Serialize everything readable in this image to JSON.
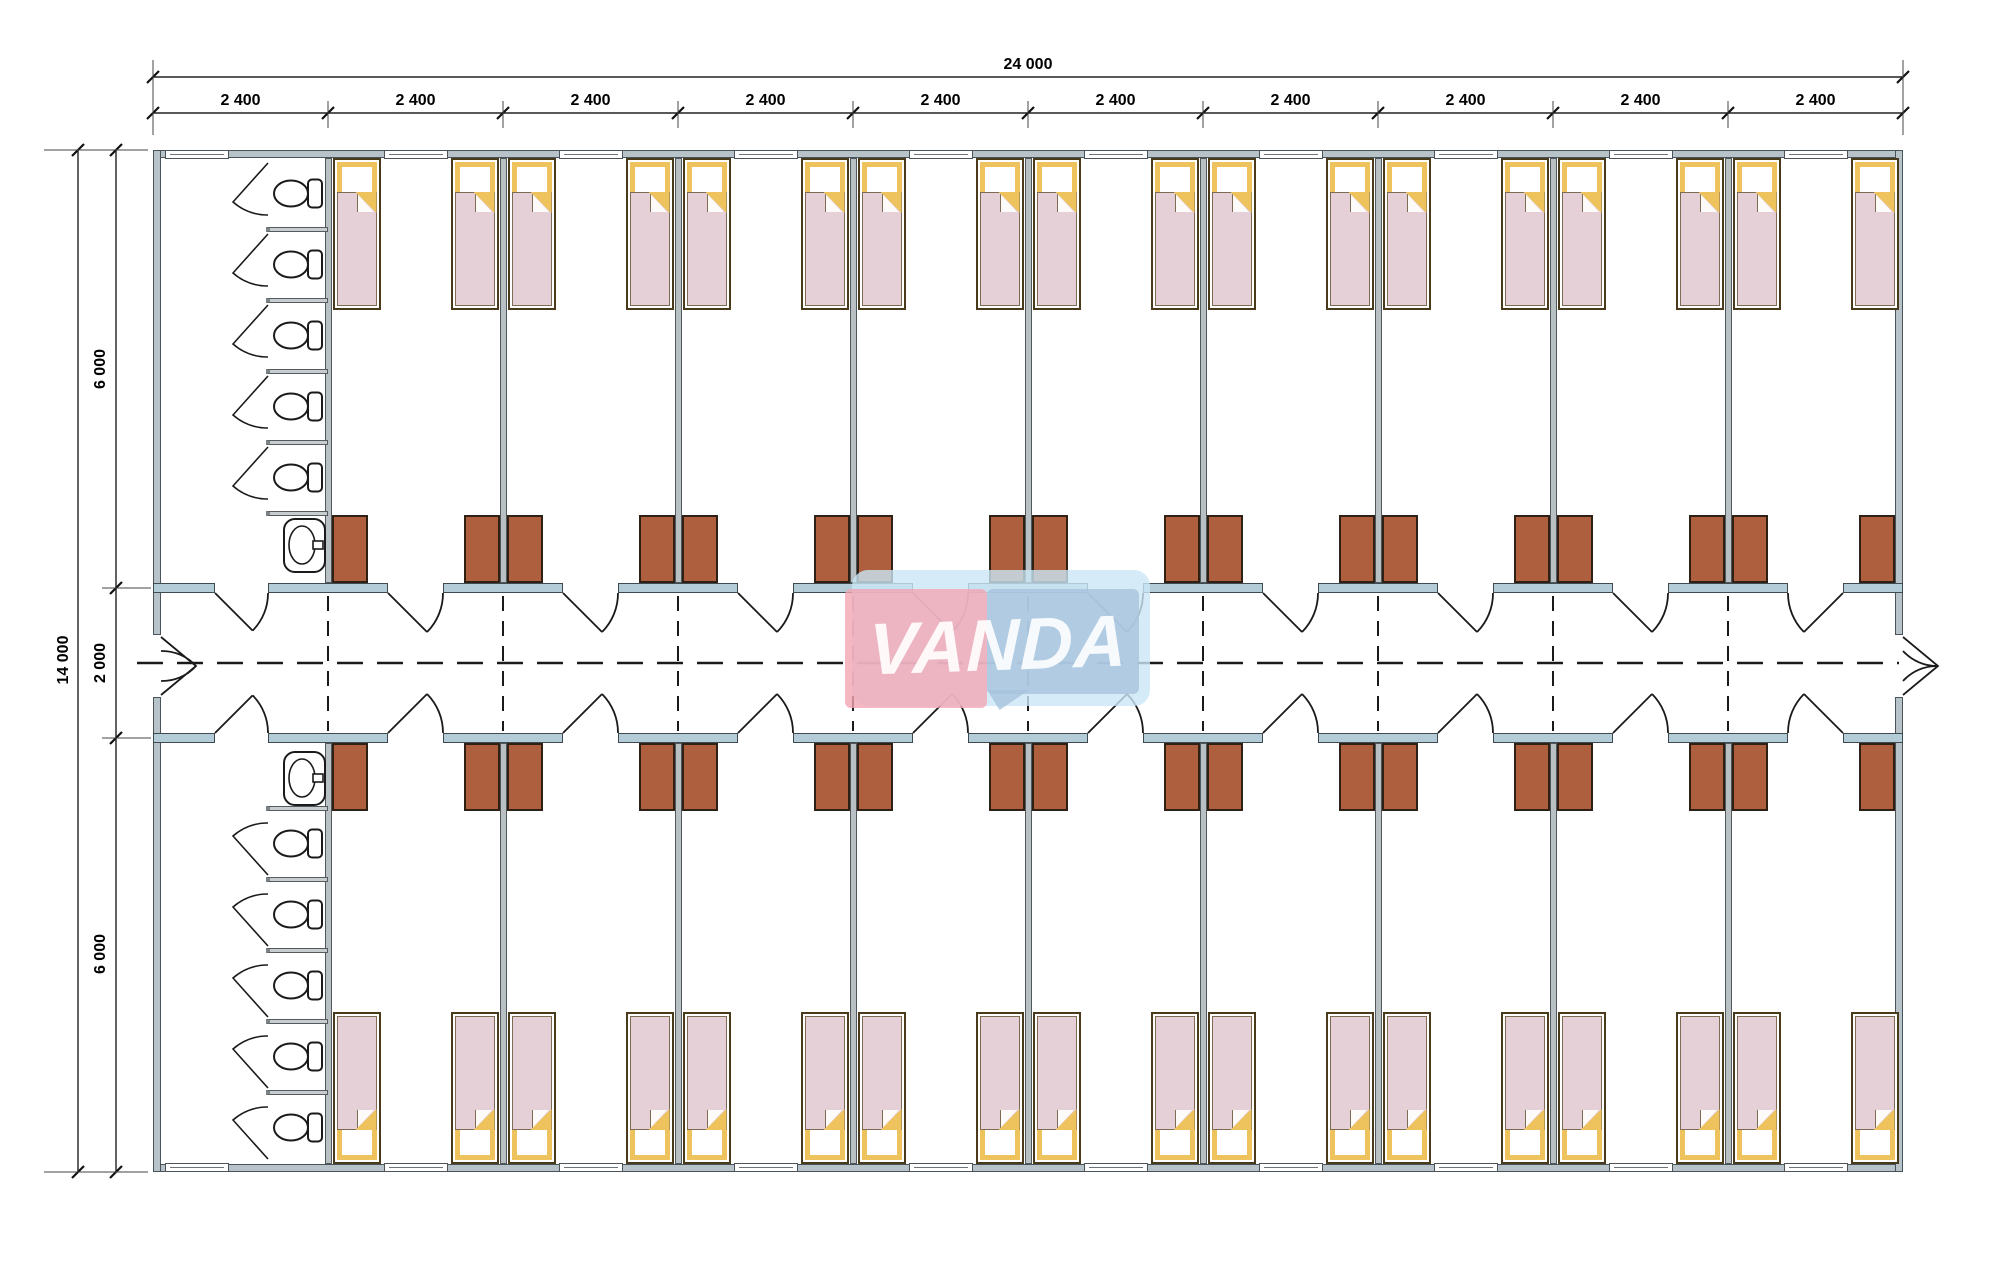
{
  "drawing": {
    "watermark": {
      "text": "VANDA"
    },
    "dimensions": {
      "overall_width": "24 000",
      "overall_height": "14 000",
      "upper_wing": "6 000",
      "corridor": "2 000",
      "lower_wing": "6 000",
      "top_segments": [
        "2 400",
        "2 400",
        "2 400",
        "2 400",
        "2 400",
        "2 400",
        "2 400",
        "2 400",
        "2 400",
        "2 400"
      ]
    },
    "layout": {
      "modules": 10,
      "bedrooms": 9,
      "beds_per_room": 2,
      "wings": 2,
      "toilet_stalls_per_wing": 5,
      "washbasins_per_wing": 1,
      "wardrobes_per_room": 2
    },
    "colors": {
      "wall_fill": "#b7c3c9",
      "corridor_wall_fill": "#b3ccd8",
      "bed_blanket": "#e5d0d8",
      "bed_pillow_frame": "#eec25c",
      "bed_frame": "#4a3a1c",
      "wardrobe": "#ae5f3d",
      "watermark_pink": "#f3a6b4",
      "watermark_pale_blue": "#cbe7f6",
      "watermark_steel_blue": "#a7c3dd",
      "line": "#1a1a1a"
    }
  }
}
